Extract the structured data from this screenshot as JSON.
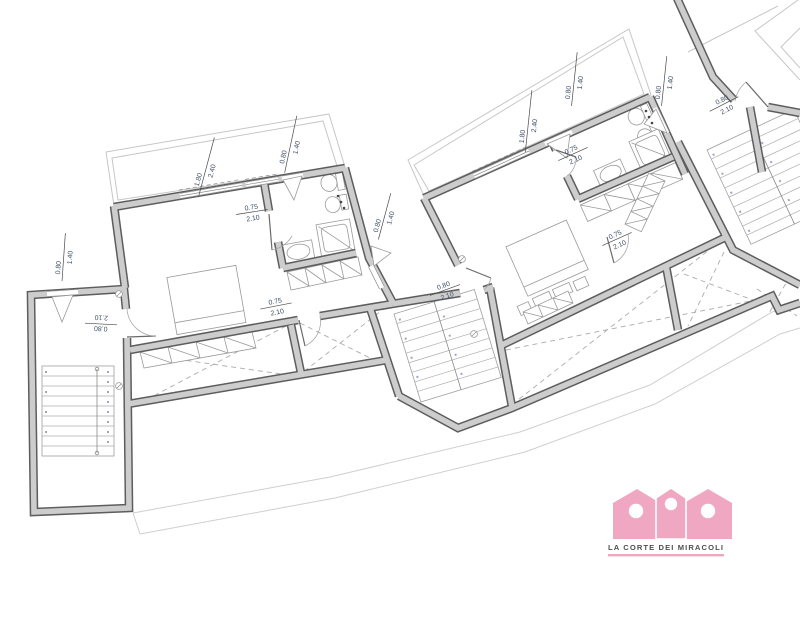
{
  "colors": {
    "accent_pink": "#f0a7c1",
    "wall_gray": "#cdcdcd",
    "dimension_text": "#3e4e66"
  },
  "logo": {
    "name": "LA CORTE DEI MIRACOLI"
  },
  "labels": {
    "l1": {
      "kind": "window",
      "top": "1.80",
      "bottom": "2.40"
    },
    "l2": {
      "kind": "window",
      "top": "0.80",
      "bottom": "1.40"
    },
    "l3": {
      "kind": "door",
      "top": "0.75",
      "bottom": "2.10"
    },
    "l4": {
      "kind": "door",
      "top": "0.75",
      "bottom": "2.10"
    },
    "l5": {
      "kind": "window",
      "top": "0.80",
      "bottom": "1.40"
    },
    "l6": {
      "kind": "door",
      "top": "0.80",
      "bottom": "2.10"
    },
    "l7": {
      "kind": "door",
      "top": "0.80",
      "bottom": "2.10"
    },
    "l8": {
      "kind": "window",
      "top": "1.80",
      "bottom": "2.40"
    },
    "l9": {
      "kind": "window",
      "top": "0.80",
      "bottom": "1.40"
    },
    "l10": {
      "kind": "window",
      "top": "0.80",
      "bottom": "1.40"
    },
    "l11": {
      "kind": "door",
      "top": "0.75",
      "bottom": "2.10"
    },
    "l12": {
      "kind": "door",
      "top": "0.75",
      "bottom": "2.10"
    },
    "l13": {
      "kind": "door",
      "top": "0.80",
      "bottom": "2.10"
    },
    "l14": {
      "kind": "window",
      "top": "0.80",
      "bottom": "1.40"
    }
  }
}
